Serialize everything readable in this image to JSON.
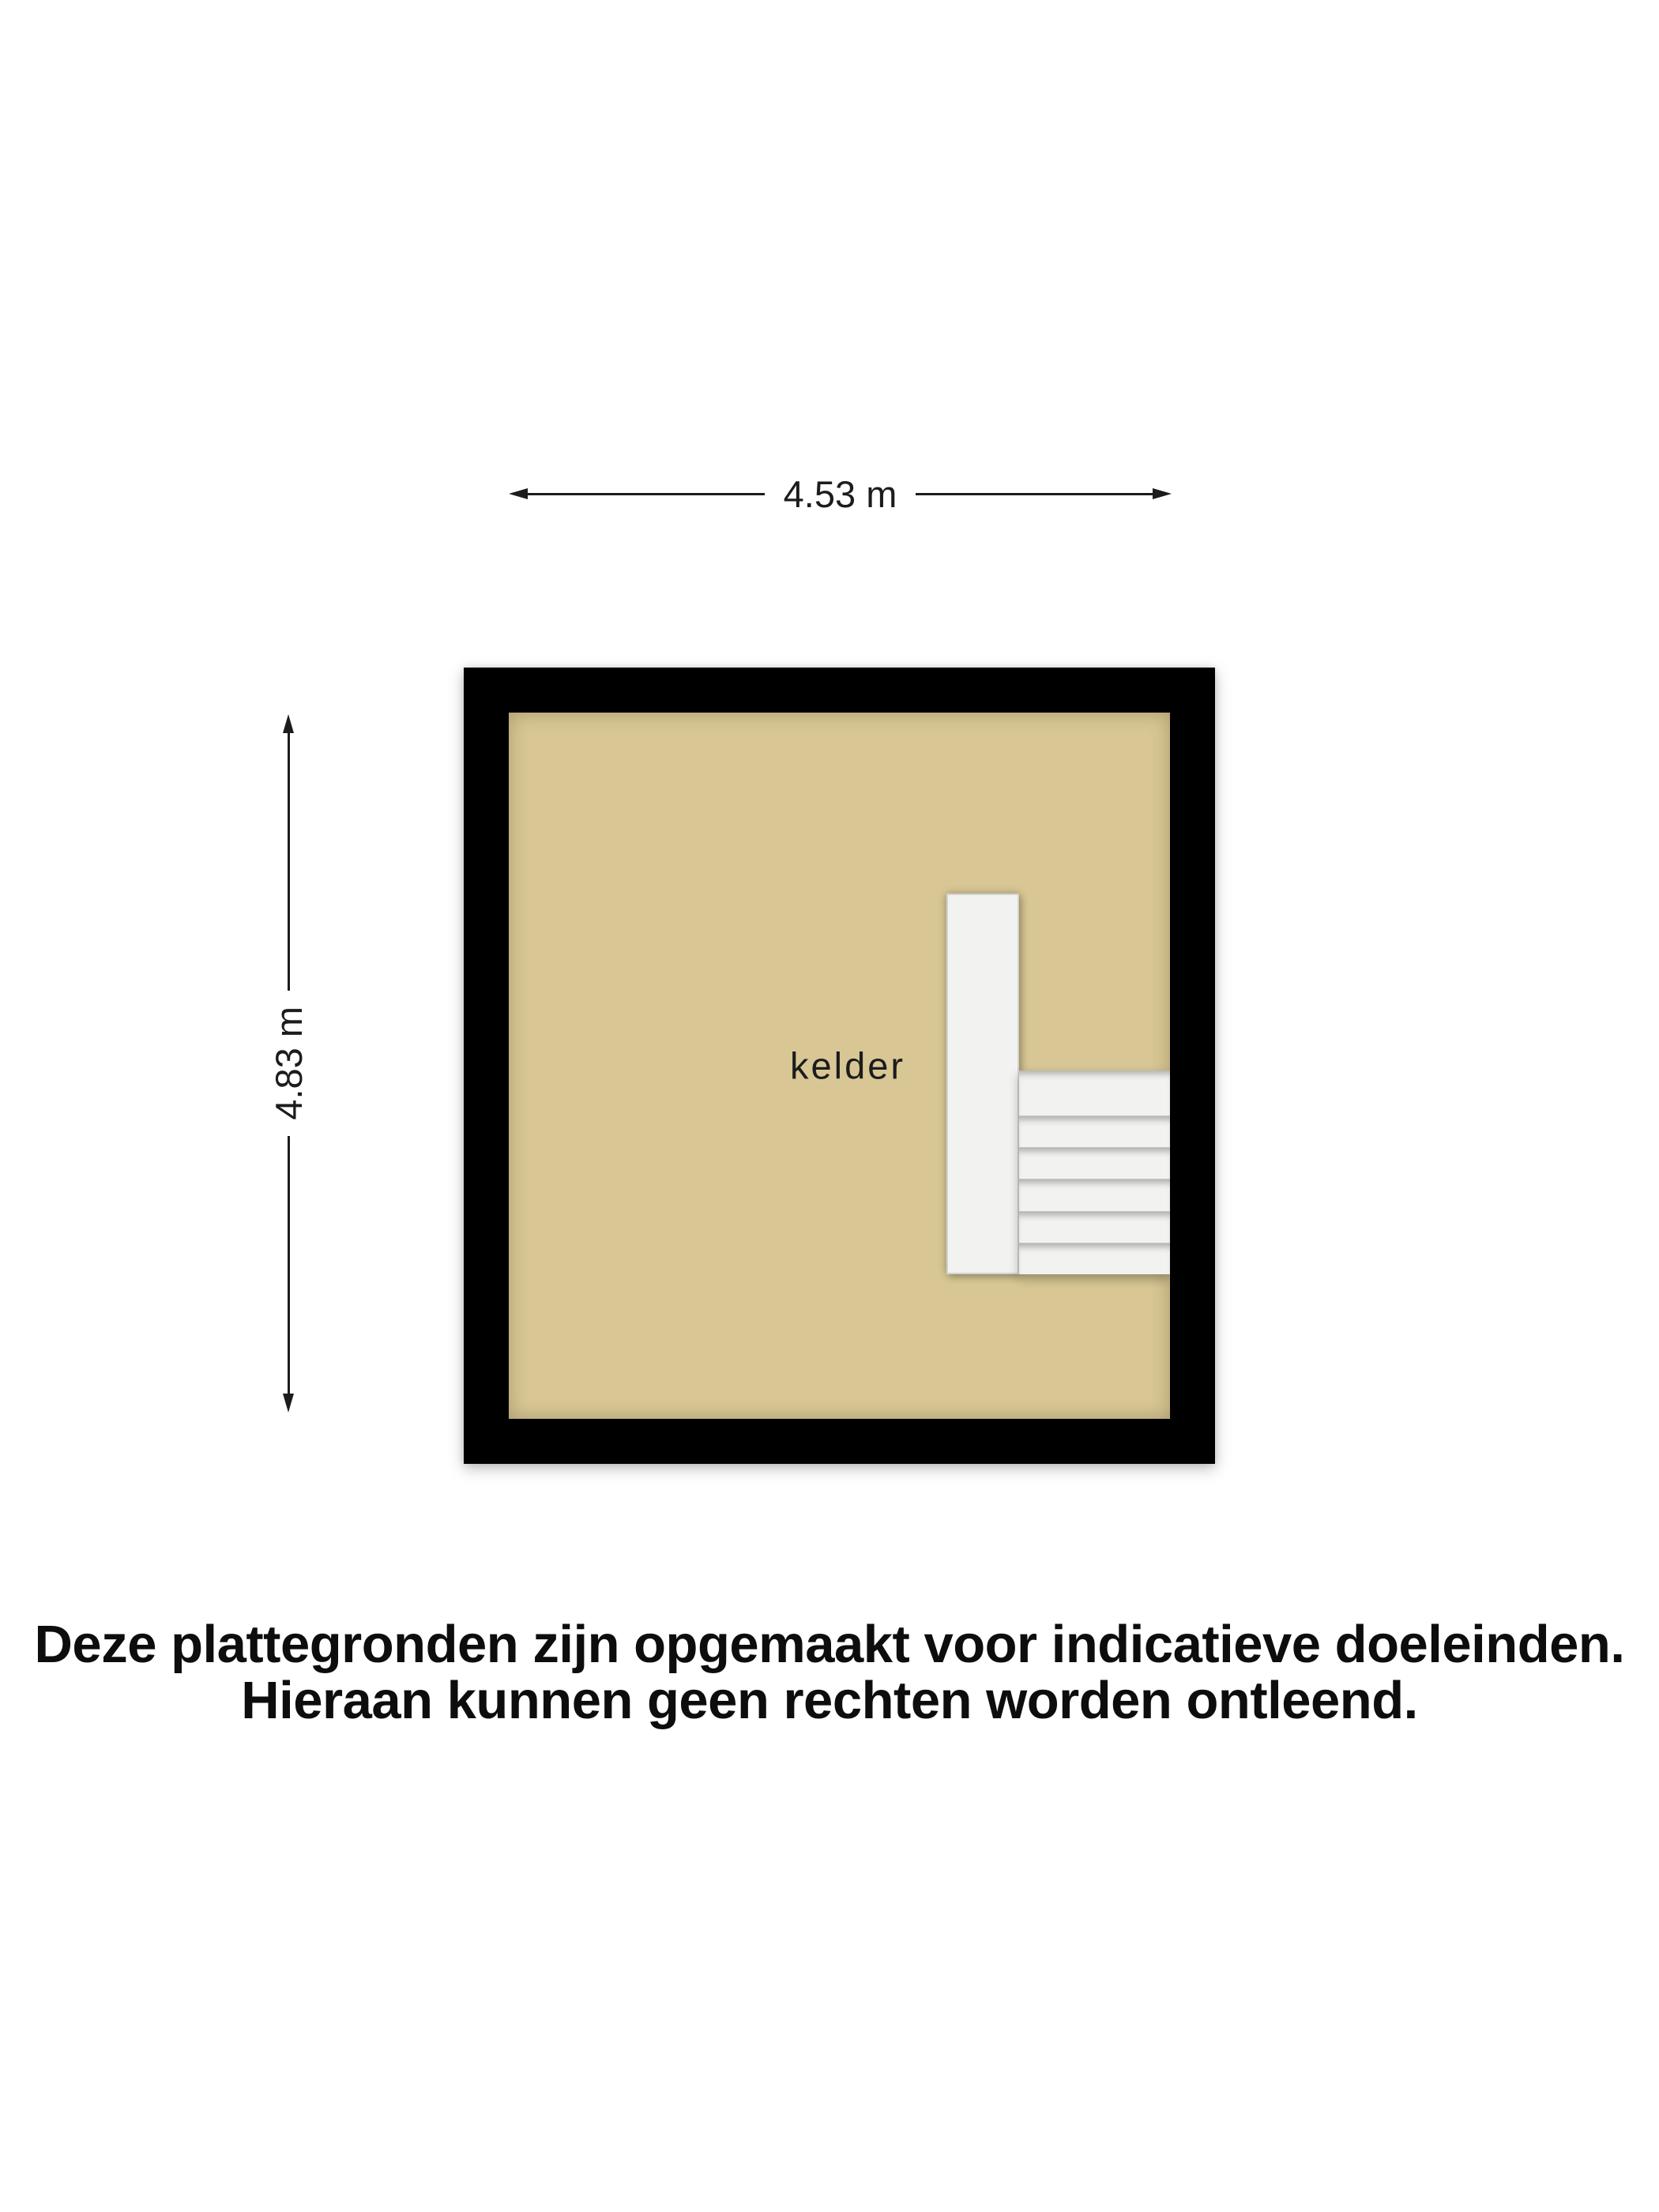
{
  "dimensions": {
    "width": {
      "label": "4.53 m"
    },
    "height": {
      "label": "4.83 m"
    }
  },
  "rooms": [
    {
      "name": "kelder"
    }
  ],
  "disclaimer": {
    "line1": "Deze plattegronden zijn opgemaakt voor indicatieve doeleinden.",
    "line2": "Hieraan kunnen geen rechten worden ontleend."
  },
  "colors": {
    "floor": "#d8c794",
    "wall": "#000000",
    "stair": "#f2f2f1",
    "dimension-line": "#1c1c1c",
    "label-text": "#1c1c1c",
    "disclaimer-text": "#0d0d0d"
  }
}
